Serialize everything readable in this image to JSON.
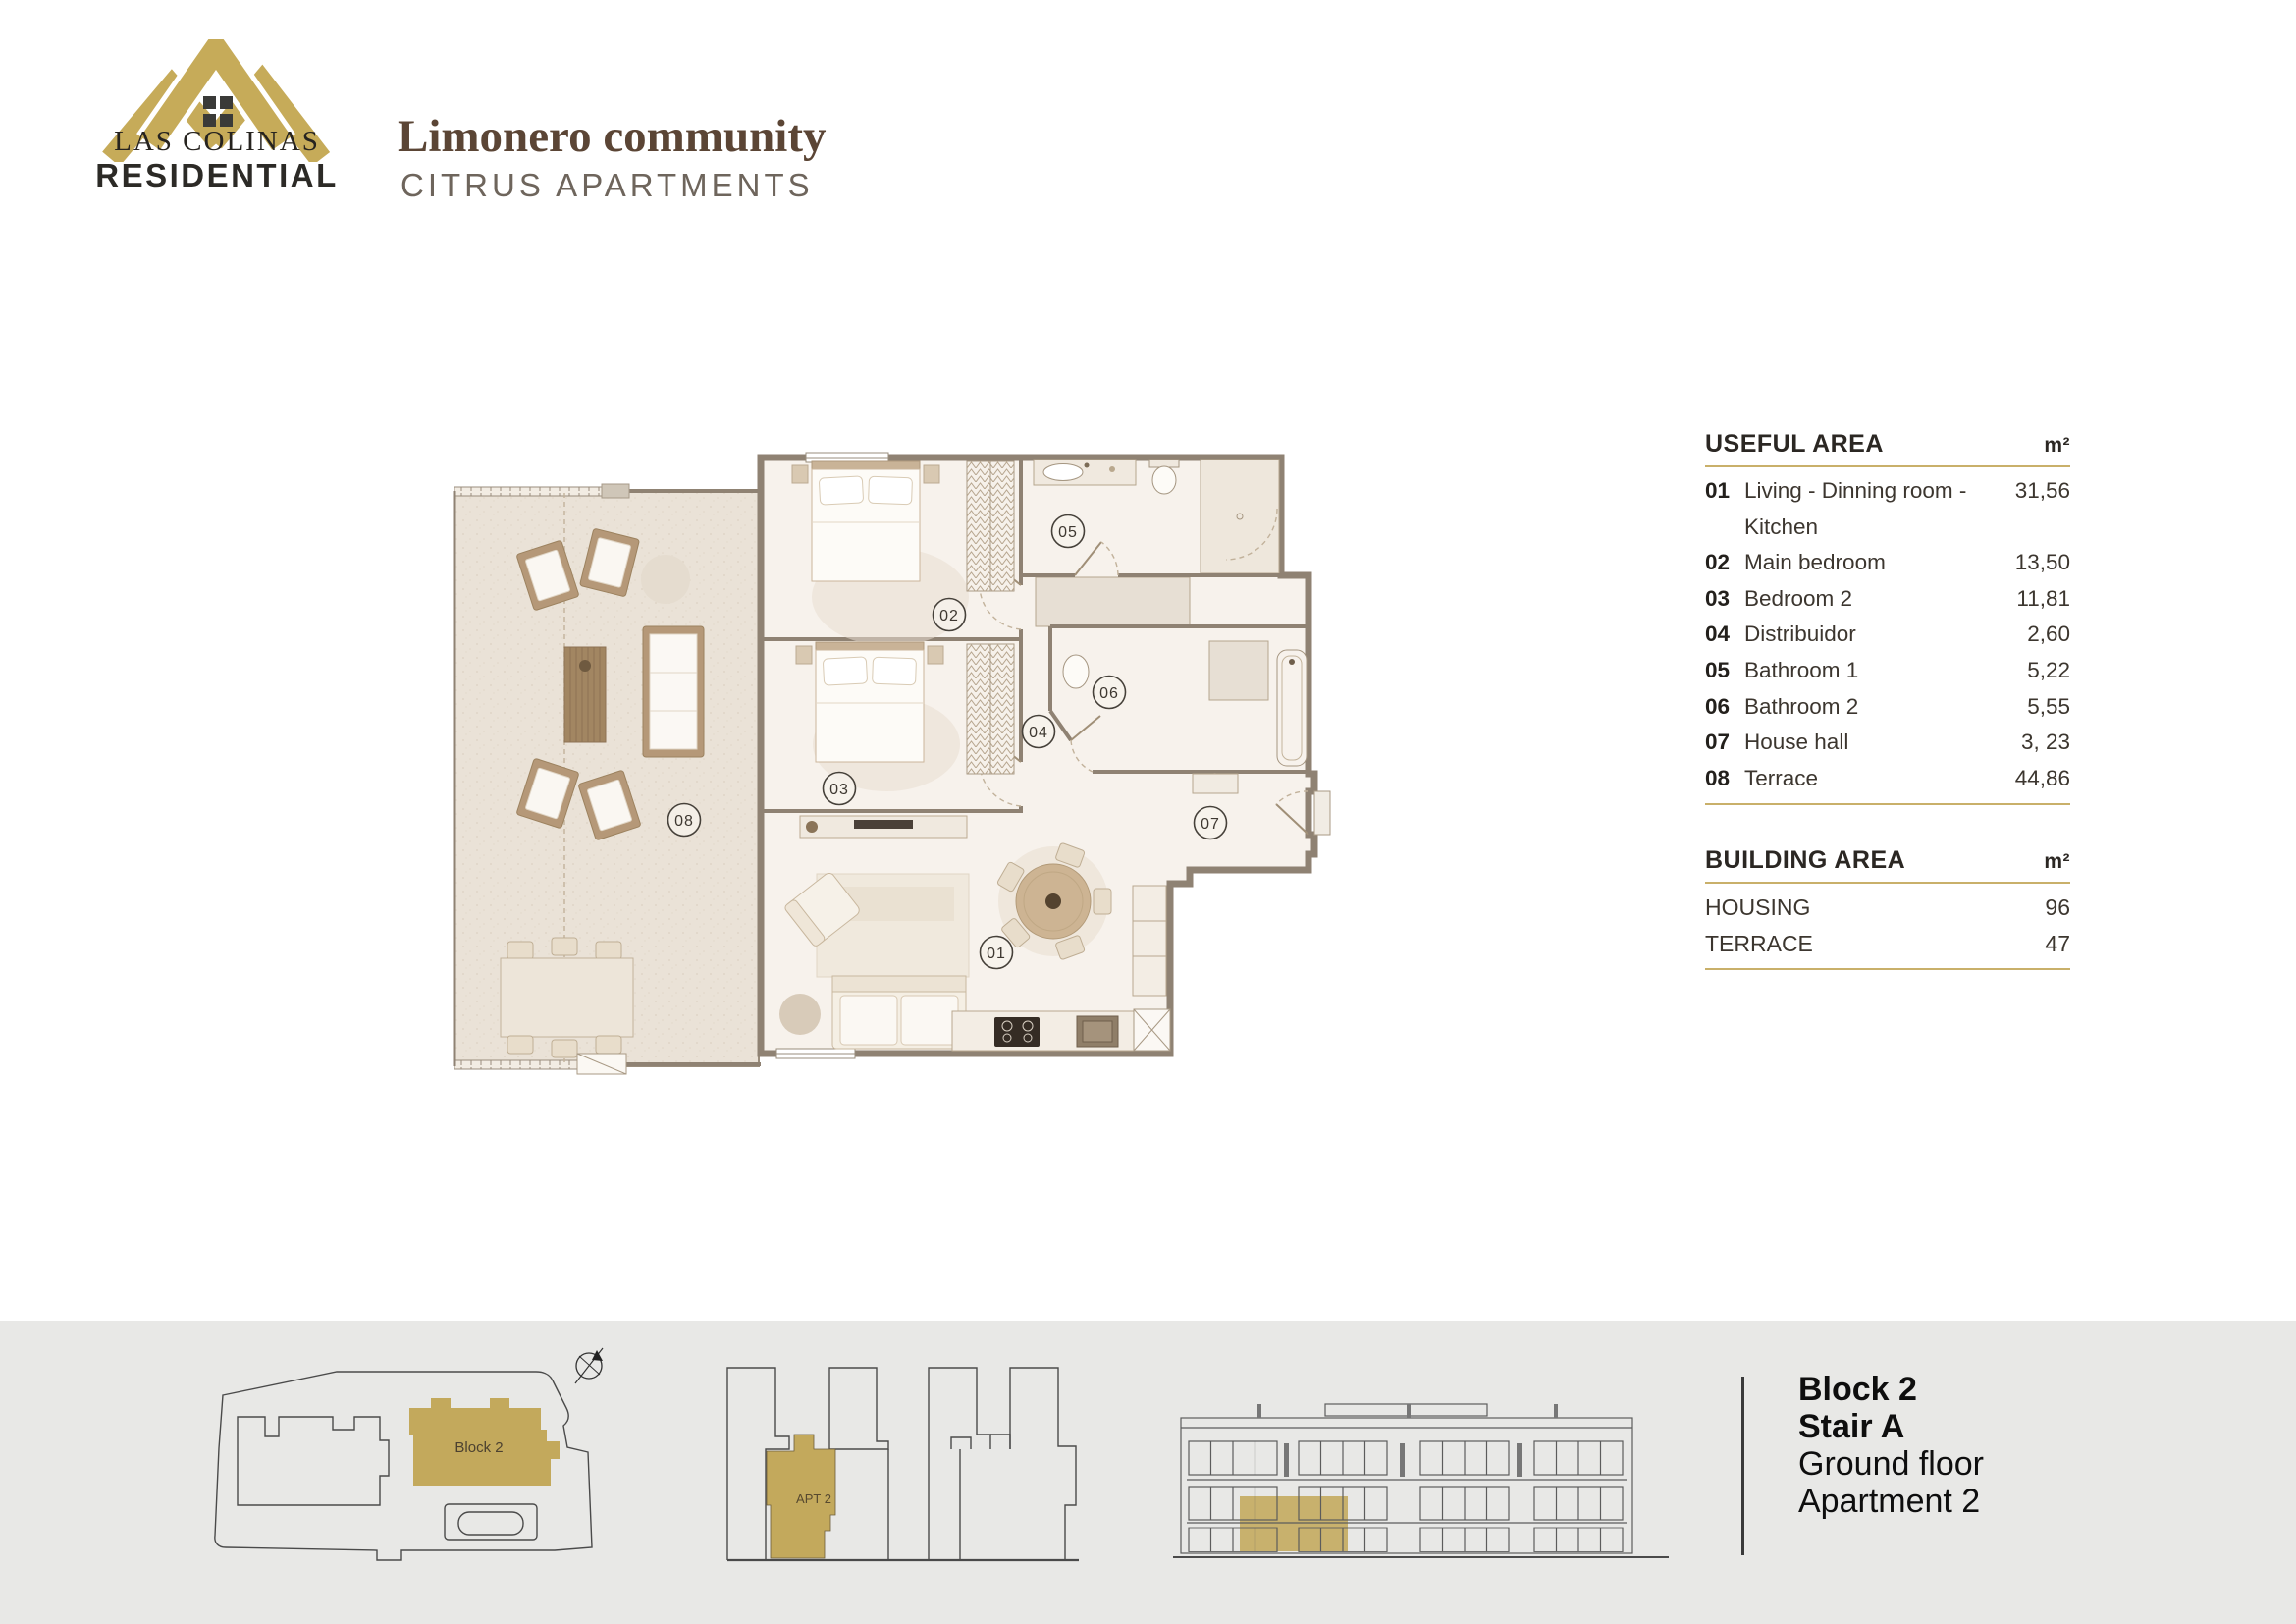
{
  "brand": {
    "name_top": "LAS COLINAS",
    "name_bottom": "RESIDENTIAL"
  },
  "header": {
    "title": "Limonero community",
    "subtitle": "CITRUS APARTMENTS"
  },
  "useful_area": {
    "title": "USEFUL AREA",
    "unit": "m²",
    "rows": [
      {
        "num": "01",
        "label": "Living - Dinning room - Kitchen",
        "value": "31,56"
      },
      {
        "num": "02",
        "label": "Main bedroom",
        "value": "13,50"
      },
      {
        "num": "03",
        "label": "Bedroom 2",
        "value": "11,81"
      },
      {
        "num": "04",
        "label": "Distribuidor",
        "value": "2,60"
      },
      {
        "num": "05",
        "label": "Bathroom 1",
        "value": "5,22"
      },
      {
        "num": "06",
        "label": "Bathroom 2",
        "value": "5,55"
      },
      {
        "num": "07",
        "label": "House hall",
        "value": "3, 23"
      },
      {
        "num": "08",
        "label": "Terrace",
        "value": "44,86"
      }
    ]
  },
  "building_area": {
    "title": "BUILDING AREA",
    "unit": "m²",
    "rows": [
      {
        "label": "HOUSING",
        "value": "96"
      },
      {
        "label": "TERRACE",
        "value": "47"
      }
    ]
  },
  "plan": {
    "rooms": [
      "01",
      "02",
      "03",
      "04",
      "05",
      "06",
      "07",
      "08"
    ]
  },
  "strip": {
    "site_plan_label": "Block 2",
    "section_label": "APT 2",
    "info_lines": [
      "Block 2",
      "Stair A",
      "Ground floor",
      "Apartment 2"
    ]
  },
  "colors": {
    "gold": "#c3a95c",
    "title_brown": "#5b4535",
    "strip_bg": "#e8e8e6",
    "rule_gold": "#c9b06a"
  }
}
